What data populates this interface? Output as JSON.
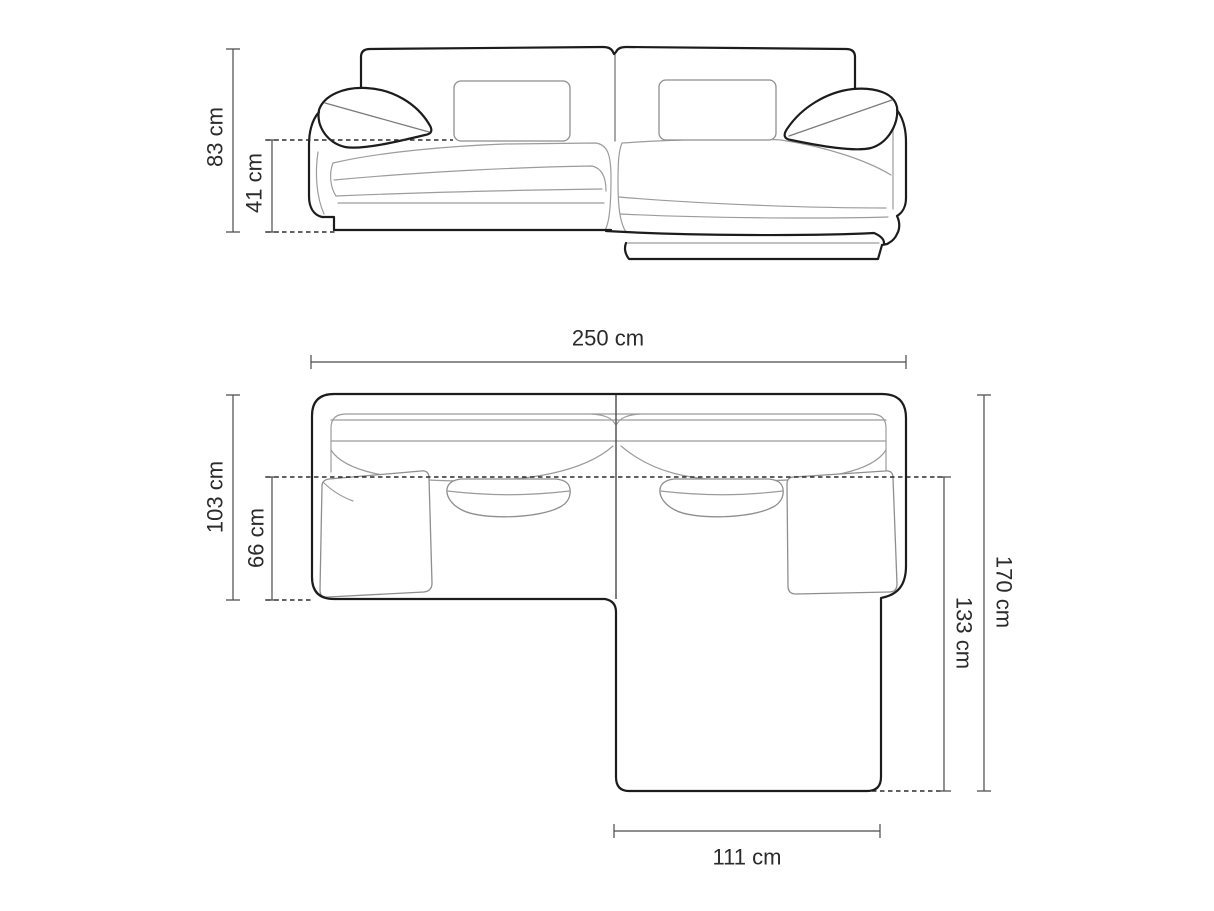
{
  "page": {
    "background_color": "#ffffff"
  },
  "diagram": {
    "type": "corner-sofa-dimension-diagram",
    "unit": "cm",
    "colors": {
      "outline": "#1c1c1c",
      "detail_lines": "#9c9c9c",
      "pillow_lines": "#8e8e8e",
      "dimension_lines": "#4b4b4b",
      "dashed_lines": "#2b2b2b",
      "label_text": "#2b2b2b",
      "background": "#ffffff"
    },
    "front_view": {
      "dimensions": {
        "overall_height": {
          "value": 83,
          "unit": "cm",
          "label": "83 cm"
        },
        "seat_height": {
          "value": 41,
          "unit": "cm",
          "label": "41 cm"
        }
      }
    },
    "top_view": {
      "dimensions": {
        "overall_width": {
          "value": 250,
          "unit": "cm",
          "label": "250 cm"
        },
        "left_side_depth": {
          "value": 103,
          "unit": "cm",
          "label": "103 cm"
        },
        "seat_depth": {
          "value": 66,
          "unit": "cm",
          "label": "66 cm"
        },
        "overall_depth": {
          "value": 170,
          "unit": "cm",
          "label": "170 cm"
        },
        "chaise_length": {
          "value": 133,
          "unit": "cm",
          "label": "133 cm"
        },
        "chaise_width": {
          "value": 111,
          "unit": "cm",
          "label": "111 cm"
        }
      }
    }
  }
}
